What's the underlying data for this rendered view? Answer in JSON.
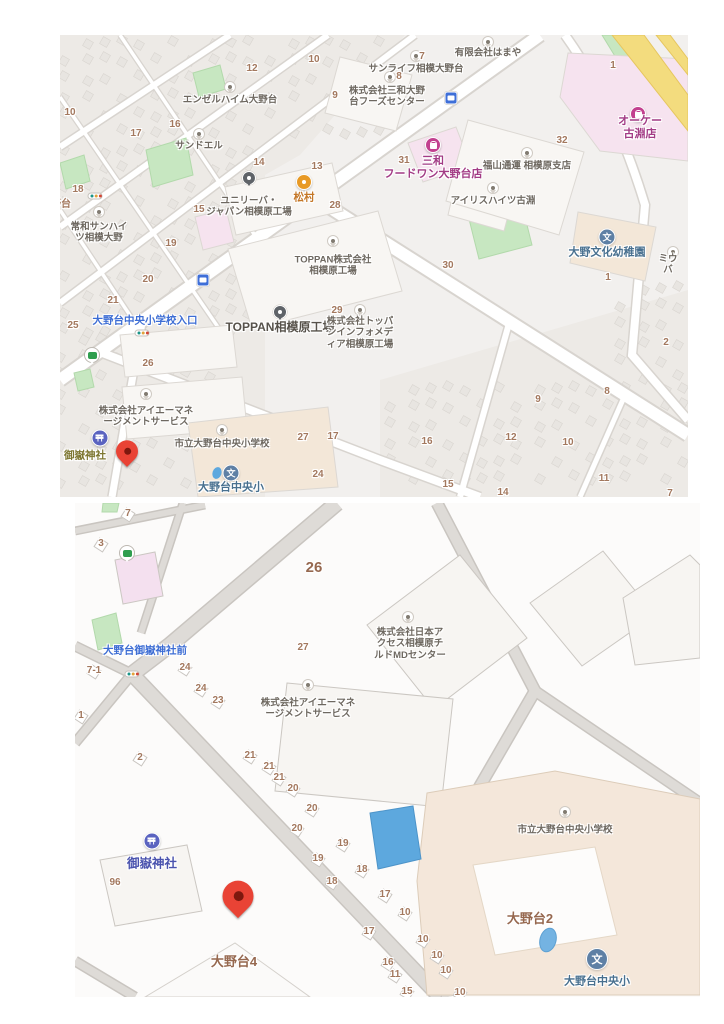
{
  "colors": {
    "map_bg_top": "#f2f0ee",
    "map_bg_bottom": "#fcfbfa",
    "road_fill": "#ffffff",
    "road_casing": "#d8d4cf",
    "road_gray": "#dedbd7",
    "park_green": "#c7e7c1",
    "commercial_pink": "#f6e3ef",
    "school_beige": "#f3e7d8",
    "highway_yellow": "#f3dc7e",
    "water_blue": "#5da8de",
    "poi_label": "#6e6860",
    "block_number": "#a3785e",
    "district_label": "#96684f",
    "transit_label": "#3d6dd4",
    "shop_label": "#a23b85",
    "food_label": "#c47727",
    "school_label": "#48708f",
    "factory_label": "#57524b",
    "shrine_label_top": "#7d7630",
    "shrine_label_bottom": "#4a53ae",
    "red_pin": "#e94335",
    "shop_pin": "#c2408f",
    "orange_pin": "#e89a25",
    "school_pin": "#5e80a5",
    "shrine_pin": "#5a63c0",
    "bus_blue": "#3f6fd8",
    "bus_green": "#2f9e4e",
    "generic_pin_dot": "#817b71",
    "dark_pin": "#5f6368"
  },
  "maps": [
    {
      "id": "map1",
      "frame": {
        "left": 60,
        "top": 35,
        "width": 628,
        "height": 462
      },
      "pois": [
        {
          "type": "generic",
          "x": 170,
          "y": 52
        },
        {
          "type": "generic",
          "x": 139,
          "y": 99
        },
        {
          "type": "generic",
          "x": 428,
          "y": 7
        },
        {
          "type": "generic",
          "x": 356,
          "y": 21
        },
        {
          "type": "generic",
          "x": 330,
          "y": 42
        },
        {
          "type": "generic",
          "x": 39,
          "y": 177
        },
        {
          "type": "generic",
          "x": 273,
          "y": 206
        },
        {
          "type": "generic",
          "x": 300,
          "y": 275
        },
        {
          "type": "generic",
          "x": 433,
          "y": 153
        },
        {
          "type": "generic",
          "x": 467,
          "y": 118
        },
        {
          "type": "generic",
          "x": 86,
          "y": 359
        },
        {
          "type": "generic",
          "x": 162,
          "y": 395
        },
        {
          "type": "generic",
          "x": 613,
          "y": 217
        },
        {
          "type": "dark",
          "x": 189,
          "y": 143
        },
        {
          "type": "dark",
          "x": 220,
          "y": 277
        },
        {
          "type": "school",
          "x": 547,
          "y": 202
        },
        {
          "type": "school",
          "x": 171,
          "y": 438
        },
        {
          "type": "pond",
          "x": 157,
          "y": 438
        },
        {
          "type": "shrine",
          "x": 40,
          "y": 403
        },
        {
          "type": "red",
          "x": 67,
          "y": 424
        },
        {
          "type": "shopping",
          "x": 373,
          "y": 110
        },
        {
          "type": "shopping",
          "x": 578,
          "y": 79
        },
        {
          "type": "orange",
          "x": 244,
          "y": 147
        },
        {
          "type": "bus-blue",
          "x": 391,
          "y": 63
        },
        {
          "type": "bus-blue",
          "x": 143,
          "y": 245
        },
        {
          "type": "bus-green",
          "x": 32,
          "y": 320
        },
        {
          "type": "traffic",
          "x": 35,
          "y": 161
        },
        {
          "type": "traffic",
          "x": 82,
          "y": 298
        }
      ],
      "labels": [
        {
          "k": "poi",
          "t": "エンゼルハイム大野台",
          "x": 170,
          "y": 65
        },
        {
          "k": "poi",
          "t": "サンドエル",
          "x": 139,
          "y": 111
        },
        {
          "k": "poi",
          "t": "有限会社はまや",
          "x": 428,
          "y": 18
        },
        {
          "k": "poi",
          "t": "サンライフ相模大野台",
          "x": 356,
          "y": 34
        },
        {
          "k": "poi",
          "t": "株式会社三和大野\n台フーズセンター",
          "x": 327,
          "y": 62
        },
        {
          "k": "poi",
          "t": "ユニリーバ・\nジャパン相模原工場",
          "x": 189,
          "y": 172
        },
        {
          "k": "poi",
          "t": "常和サンハイ\nツ相模大野",
          "x": 39,
          "y": 198
        },
        {
          "k": "poi",
          "t": "TOPPAN株式会社\n相模原工場",
          "x": 273,
          "y": 231
        },
        {
          "k": "factory",
          "t": "TOPPAN相模原工場",
          "x": 220,
          "y": 292
        },
        {
          "k": "poi",
          "t": "株式会社トッパ\nンインフォメデ\nィア相模原工場",
          "x": 300,
          "y": 298
        },
        {
          "k": "poi",
          "t": "アイリスハイツ古淵",
          "x": 433,
          "y": 166
        },
        {
          "k": "poi",
          "t": "福山通運 相模原支店",
          "x": 467,
          "y": 131
        },
        {
          "k": "poi",
          "t": "株式会社アイエーマネ\nージメントサービス",
          "x": 86,
          "y": 382
        },
        {
          "k": "poi",
          "t": "市立大野台中央小学校",
          "x": 162,
          "y": 409
        },
        {
          "k": "school",
          "t": "大野文化幼稚園",
          "x": 547,
          "y": 218
        },
        {
          "k": "school",
          "t": "大野台中央小",
          "x": 171,
          "y": 453
        },
        {
          "k": "shrine1",
          "t": "御嶽神社",
          "x": 25,
          "y": 421
        },
        {
          "k": "food",
          "t": "松村",
          "x": 244,
          "y": 163
        },
        {
          "k": "shop",
          "t": "三和\nフードワン大野台店",
          "x": 373,
          "y": 133
        },
        {
          "k": "shop",
          "t": "オーケー 古淵店",
          "x": 580,
          "y": 93
        },
        {
          "k": "transit",
          "t": "大野台中央小学校入口",
          "x": 85,
          "y": 286
        },
        {
          "k": "num",
          "t": "大野台",
          "x": -4,
          "y": 170
        },
        {
          "k": "poi",
          "t": "ミウバ",
          "x": 608,
          "y": 230
        },
        {
          "k": "num",
          "t": "12",
          "x": 192,
          "y": 34
        },
        {
          "k": "num",
          "t": "10",
          "x": 254,
          "y": 25
        },
        {
          "k": "num",
          "t": "9",
          "x": 275,
          "y": 61
        },
        {
          "k": "num",
          "t": "10",
          "x": 10,
          "y": 78
        },
        {
          "k": "num",
          "t": "16",
          "x": 115,
          "y": 90
        },
        {
          "k": "num",
          "t": "17",
          "x": 76,
          "y": 99
        },
        {
          "k": "num",
          "t": "14",
          "x": 199,
          "y": 128
        },
        {
          "k": "num",
          "t": "13",
          "x": 257,
          "y": 132
        },
        {
          "k": "num",
          "t": "18",
          "x": 18,
          "y": 155
        },
        {
          "k": "num",
          "t": "15",
          "x": 139,
          "y": 175
        },
        {
          "k": "num",
          "t": "28",
          "x": 275,
          "y": 171
        },
        {
          "k": "num",
          "t": "19",
          "x": 111,
          "y": 209
        },
        {
          "k": "num",
          "t": "20",
          "x": 88,
          "y": 245
        },
        {
          "k": "num",
          "t": "21",
          "x": 53,
          "y": 266
        },
        {
          "k": "num",
          "t": "25",
          "x": 13,
          "y": 291
        },
        {
          "k": "num",
          "t": "29",
          "x": 277,
          "y": 276
        },
        {
          "k": "num",
          "t": "7",
          "x": 362,
          "y": 22
        },
        {
          "k": "num",
          "t": "8",
          "x": 339,
          "y": 42
        },
        {
          "k": "num",
          "t": "1",
          "x": 553,
          "y": 31
        },
        {
          "k": "num",
          "t": "32",
          "x": 502,
          "y": 106
        },
        {
          "k": "num",
          "t": "31",
          "x": 344,
          "y": 126
        },
        {
          "k": "num",
          "t": "30",
          "x": 388,
          "y": 231
        },
        {
          "k": "num",
          "t": "1",
          "x": 548,
          "y": 243
        },
        {
          "k": "num",
          "t": "26",
          "x": 88,
          "y": 329
        },
        {
          "k": "num",
          "t": "27",
          "x": 243,
          "y": 403
        },
        {
          "k": "num",
          "t": "17",
          "x": 273,
          "y": 402
        },
        {
          "k": "num",
          "t": "24",
          "x": 258,
          "y": 440
        },
        {
          "k": "num",
          "t": "2",
          "x": 606,
          "y": 308
        },
        {
          "k": "num",
          "t": "8",
          "x": 547,
          "y": 357
        },
        {
          "k": "num",
          "t": "9",
          "x": 478,
          "y": 365
        },
        {
          "k": "num",
          "t": "16",
          "x": 367,
          "y": 407
        },
        {
          "k": "num",
          "t": "12",
          "x": 451,
          "y": 403
        },
        {
          "k": "num",
          "t": "10",
          "x": 508,
          "y": 408
        },
        {
          "k": "num",
          "t": "11",
          "x": 544,
          "y": 444
        },
        {
          "k": "num",
          "t": "15",
          "x": 388,
          "y": 450
        },
        {
          "k": "num",
          "t": "14",
          "x": 443,
          "y": 458
        },
        {
          "k": "num",
          "t": "7",
          "x": 610,
          "y": 459
        }
      ]
    },
    {
      "id": "map2",
      "frame": {
        "left": 75,
        "top": 503,
        "width": 625,
        "height": 494
      },
      "pois": [
        {
          "type": "bus-green",
          "x": 52,
          "y": 50
        },
        {
          "type": "traffic",
          "x": 57,
          "y": 171
        },
        {
          "type": "generic",
          "x": 333,
          "y": 114
        },
        {
          "type": "generic",
          "x": 233,
          "y": 182
        },
        {
          "type": "generic",
          "x": 490,
          "y": 309
        },
        {
          "type": "school",
          "size": "lg",
          "x": 522,
          "y": 456
        },
        {
          "type": "shrine",
          "x": 77,
          "y": 338
        },
        {
          "type": "red",
          "size": "lg",
          "x": 163,
          "y": 404
        }
      ],
      "labels": [
        {
          "k": "transit",
          "t": "大野台御嶽神社前",
          "x": 70,
          "y": 148
        },
        {
          "k": "num-lg",
          "t": "26",
          "x": 239,
          "y": 65
        },
        {
          "k": "num",
          "t": "27",
          "x": 228,
          "y": 145
        },
        {
          "k": "poi",
          "t": "株式会社日本ア\nクセス相模原チ\nルドMDセンター",
          "x": 335,
          "y": 141
        },
        {
          "k": "poi",
          "t": "株式会社アイエーマネ\nージメントサービス",
          "x": 233,
          "y": 206
        },
        {
          "k": "poi",
          "t": "市立大野台中央小学校",
          "x": 490,
          "y": 327
        },
        {
          "k": "school",
          "t": "大野台中央小",
          "x": 522,
          "y": 479
        },
        {
          "k": "shrine2",
          "t": "御嶽神社",
          "x": 77,
          "y": 361
        },
        {
          "k": "district",
          "t": "大野台4",
          "x": 159,
          "y": 459
        },
        {
          "k": "district",
          "t": "大野台2",
          "x": 455,
          "y": 416
        },
        {
          "k": "num",
          "t": "7",
          "x": 53,
          "y": 11,
          "h": 1
        },
        {
          "k": "num",
          "t": "3",
          "x": 26,
          "y": 41,
          "h": 1
        },
        {
          "k": "num",
          "t": "7-1",
          "x": 19,
          "y": 168,
          "h": 1
        },
        {
          "k": "num",
          "t": "1",
          "x": 6,
          "y": 213,
          "h": 1
        },
        {
          "k": "num",
          "t": "24",
          "x": 110,
          "y": 165,
          "h": 1
        },
        {
          "k": "num",
          "t": "24",
          "x": 126,
          "y": 186,
          "h": 1
        },
        {
          "k": "num",
          "t": "23",
          "x": 143,
          "y": 198,
          "h": 1
        },
        {
          "k": "num",
          "t": "2",
          "x": 65,
          "y": 255,
          "h": 1
        },
        {
          "k": "num",
          "t": "21",
          "x": 175,
          "y": 253,
          "h": 1
        },
        {
          "k": "num",
          "t": "21",
          "x": 194,
          "y": 264,
          "h": 1
        },
        {
          "k": "num",
          "t": "21",
          "x": 204,
          "y": 275,
          "h": 1
        },
        {
          "k": "num",
          "t": "20",
          "x": 218,
          "y": 286,
          "h": 1
        },
        {
          "k": "num",
          "t": "20",
          "x": 237,
          "y": 306,
          "h": 1
        },
        {
          "k": "num",
          "t": "20",
          "x": 222,
          "y": 326,
          "h": 1
        },
        {
          "k": "num",
          "t": "19",
          "x": 268,
          "y": 341,
          "h": 1
        },
        {
          "k": "num",
          "t": "19",
          "x": 243,
          "y": 356,
          "h": 1
        },
        {
          "k": "num",
          "t": "18",
          "x": 287,
          "y": 367,
          "h": 1
        },
        {
          "k": "num",
          "t": "18",
          "x": 257,
          "y": 379,
          "h": 1
        },
        {
          "k": "num",
          "t": "17",
          "x": 310,
          "y": 392,
          "h": 1
        },
        {
          "k": "num",
          "t": "17",
          "x": 294,
          "y": 429,
          "h": 1
        },
        {
          "k": "num",
          "t": "16",
          "x": 313,
          "y": 460,
          "h": 1
        },
        {
          "k": "num",
          "t": "11",
          "x": 320,
          "y": 472,
          "h": 1
        },
        {
          "k": "num",
          "t": "10",
          "x": 330,
          "y": 410,
          "h": 1
        },
        {
          "k": "num",
          "t": "10",
          "x": 348,
          "y": 437,
          "h": 1
        },
        {
          "k": "num",
          "t": "10",
          "x": 362,
          "y": 453,
          "h": 1
        },
        {
          "k": "num",
          "t": "10",
          "x": 371,
          "y": 468,
          "h": 1
        },
        {
          "k": "num",
          "t": "10",
          "x": 385,
          "y": 490,
          "h": 1
        },
        {
          "k": "num",
          "t": "15",
          "x": 332,
          "y": 489,
          "h": 1
        },
        {
          "k": "num",
          "t": "96",
          "x": 40,
          "y": 380
        }
      ]
    }
  ]
}
